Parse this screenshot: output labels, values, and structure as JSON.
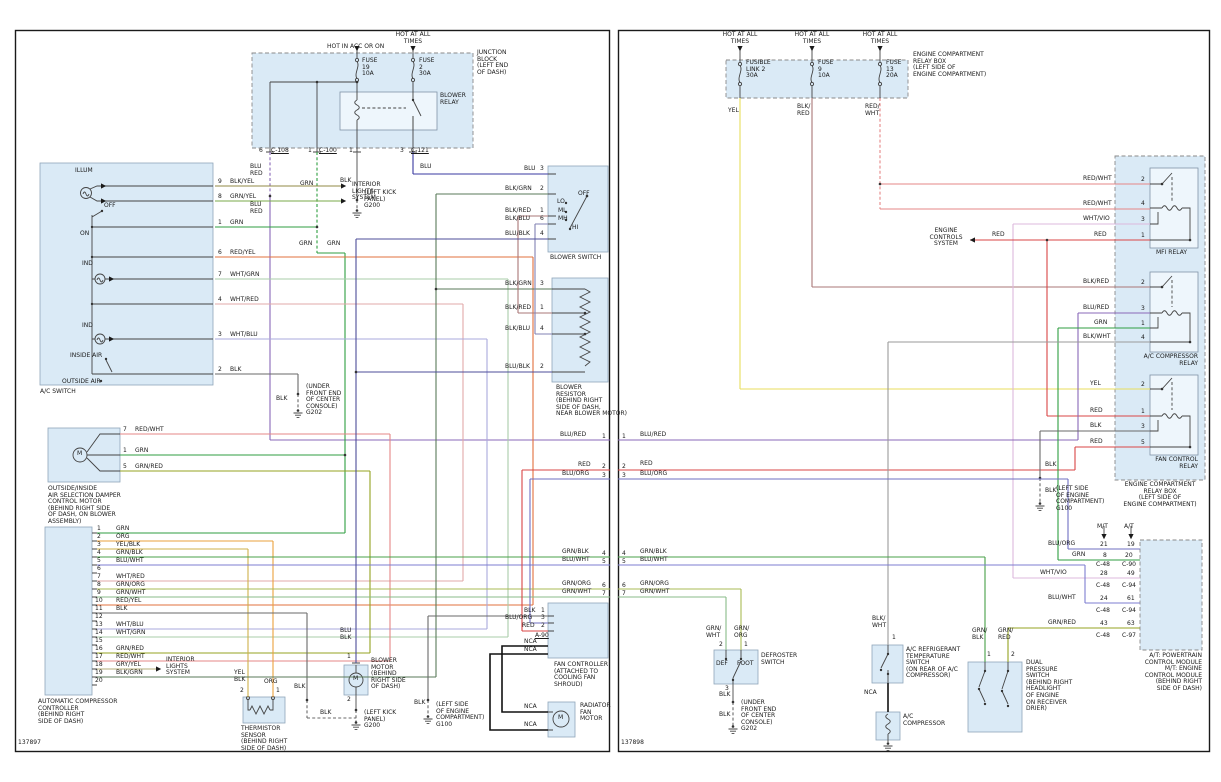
{
  "document": {
    "type": "Two-page automotive A/C system wiring schematic"
  },
  "shared": {
    "m": "M",
    "w": {
      "grn": "GRN",
      "org": "ORG",
      "yel": "YEL",
      "red": "RED",
      "blk": "BLK",
      "blu": "BLU",
      "blu_red": "BLU/RED",
      "blu_red_s": "BLU\nRED",
      "blu_org": "BLU/ORG",
      "blu_wht": "BLU/WHT",
      "blu_blk": "BLU/BLK",
      "blu_blk_s": "BLU\nBLK",
      "blk_grn": "BLK/GRN",
      "blk_red": "BLK/RED",
      "blk_red_s": "BLK/\nRED",
      "blk_blu": "BLK/BLU",
      "blk_yel": "BLK/YEL",
      "blk_wht": "BLK/WHT",
      "blk_wht_s": "BLK/\nWHT",
      "grn_yel": "GRN/YEL",
      "grn_blk": "GRN/BLK",
      "grn_blk_s": "GRN/\nBLK",
      "grn_org": "GRN/ORG",
      "grn_org_s": "GRN/\nORG",
      "grn_wht": "GRN/WHT",
      "grn_wht_s": "GRN/\nWHT",
      "grn_red": "GRN/RED",
      "grn_red_s": "GRN/\nRED",
      "red_yel": "RED/YEL",
      "red_wht": "RED/WHT",
      "red_wht_s": "RED/\nWHT",
      "wht_red": "WHT/RED",
      "wht_blu": "WHT/BLU",
      "wht_grn": "WHT/GRN",
      "wht_vio": "WHT/VIO",
      "yel_blk": "YEL/BLK",
      "yel_blk_s": "YEL\nBLK",
      "gry_yel": "GRY/YEL",
      "nca": "NCA"
    },
    "wire_hex": {
      "GRN": "#2f9e41",
      "ORG": "#eaa13e",
      "YEL": "#e8de5e",
      "RED": "#d94545",
      "BLK": "#6a6a6a",
      "BLU": "#3a3aa0",
      "BLU/RED": "#8968b8",
      "BLU/ORG": "#6f6fc2",
      "BLU/WHT": "#7d7dd0",
      "BLU/BLK": "#4d4d99",
      "BLK/GRN": "#5a7a5a",
      "BLK/RED": "#aa7777",
      "BLK/BLU": "#8181b3",
      "BLK/YEL": "#908a45",
      "BLK/WHT": "#9a9a9a",
      "GRN/YEL": "#79aa4a",
      "GRN/BLK": "#48a048",
      "GRN/ORG": "#aabb55",
      "GRN/WHT": "#88bb88",
      "GRN/RED": "#94a321",
      "RED/YEL": "#e2703c",
      "RED/WHT": "#e58787",
      "WHT/RED": "#e2a8a8",
      "WHT/BLU": "#aaaadd",
      "WHT/GRN": "#aaccaa",
      "WHT/VIO": "#dcb8dc",
      "YEL/BLK": "#cfb14a",
      "GRY/YEL": "#b5ad7a",
      "NCA": "#111111"
    },
    "p": {
      "n1": "1",
      "n2": "2",
      "n3": "3",
      "n4": "4",
      "n5": "5",
      "n6": "6",
      "n7": "7",
      "n8": "8",
      "n9": "9",
      "n10": "10",
      "n11": "11",
      "n12": "12",
      "n13": "13",
      "n14": "14",
      "n15": "15",
      "n16": "16",
      "n17": "17",
      "n18": "18",
      "n19": "19",
      "n20": "20",
      "n21": "21",
      "n24": "24",
      "n28": "28",
      "n43": "43",
      "n49": "49",
      "n61": "61",
      "n63": "63"
    },
    "conn": {
      "c108": "C-108",
      "c100": "C-100",
      "c121": "C-121",
      "c48": "C-48",
      "c90": "C-90",
      "c94": "C-94",
      "c97": "C-97",
      "a90": "A-90"
    },
    "sys": {
      "interior": "INTERIOR\nLIGHTS\nSYSTEM",
      "engine": "ENGINE\nCONTROLS\nSYSTEM"
    },
    "gnd": {
      "g200": "(LEFT KICK\nPANEL)\nG200",
      "g202": "(UNDER\nFRONT END\nOF CENTER\nCONSOLE)\nG202",
      "g100": "(LEFT SIDE\nOF ENGINE\nCOMPARTMENT)\nG100"
    }
  },
  "left": {
    "code": "137897",
    "hdr": {
      "hot_acc": "HOT IN ACC OR ON",
      "hot_all": "HOT AT ALL\nTIMES"
    },
    "fuse19": "FUSE\n19\n10A",
    "fuse2": "FUSE\n2\n30A",
    "junction": "JUNCTION\nBLOCK\n(LEFT END\nOF DASH)",
    "blower_relay": "BLOWER\nRELAY",
    "ac_switch": {
      "name": "A/C SWITCH",
      "illum": "ILLUM",
      "off": "OFF",
      "on": "ON",
      "ind": "IND",
      "inside": "INSIDE AIR",
      "outside": "OUTSIDE AIR"
    },
    "damper_motor": "OUTSIDE/INSIDE\nAIR SELECTION DAMPER\nCONTROL MOTOR\n(BEHIND RIGHT SIDE\nOF DASH, ON BLOWER\nASSEMBLY)",
    "controller": "AUTOMATIC COMPRESSOR\nCONTROLLER\n(BEHIND RIGHT\nSIDE OF DASH)",
    "thermistor": "THERMISTOR\nSENSOR\n(BEHIND RIGHT\nSIDE OF DASH)",
    "blower_motor": "BLOWER\nMOTOR\n(BEHIND\nRIGHT SIDE\nOF DASH)",
    "blower_switch": {
      "name": "BLOWER SWITCH",
      "off": "OFF",
      "lo": "LO",
      "ml": "ML",
      "mh": "MH",
      "hi": "HI"
    },
    "blower_resistor": "BLOWER\nRESISTOR\n(BEHIND RIGHT\nSIDE OF DASH,\nNEAR BLOWER MOTOR)",
    "fan_controller": "FAN CONTROLLER\n(ATTACHED TO\nCOOLING FAN\nSHROUD)",
    "radiator_fan": "RADIATOR\nFAN\nMOTOR"
  },
  "right": {
    "code": "137898",
    "hdr": {
      "hot_all": "HOT AT ALL\nTIMES"
    },
    "fusible_link": "FUSIBLE\nLINK 2\n30A",
    "fuse9": "FUSE\n9\n10A",
    "fuse13": "FUSE\n13\n20A",
    "relay_box": "ENGINE COMPARTMENT\nRELAY BOX\n(LEFT SIDE OF\nENGINE COMPARTMENT)",
    "mfi_relay": "MFI RELAY",
    "ac_relay": "A/C COMPRESSOR\nRELAY",
    "fan_relay": "FAN CONTROL\nRELAY",
    "defroster": {
      "name": "DEFROSTER\nSWITCH",
      "def": "DEF",
      "foot": "FOOT"
    },
    "temp_switch": "A/C REFRIGERANT\nTEMPERATURE\nSWITCH\n(ON REAR OF A/C\nCOMPRESSOR)",
    "compressor": "A/C\nCOMPRESSOR",
    "dual_pressure": "DUAL\nPRESSURE\nSWITCH\n(BEHIND RIGHT\nHEADLIGHT\nOF ENGINE\nON RECEIVER\nDRIER)",
    "pcm": {
      "label": "A/T: POWERTRAIN\nCONTROL MODULE\nM/T: ENGINE\nCONTROL MODULE\n(BEHIND RIGHT\nSIDE OF DASH)",
      "mt": "M/T",
      "at": "A/T"
    }
  }
}
